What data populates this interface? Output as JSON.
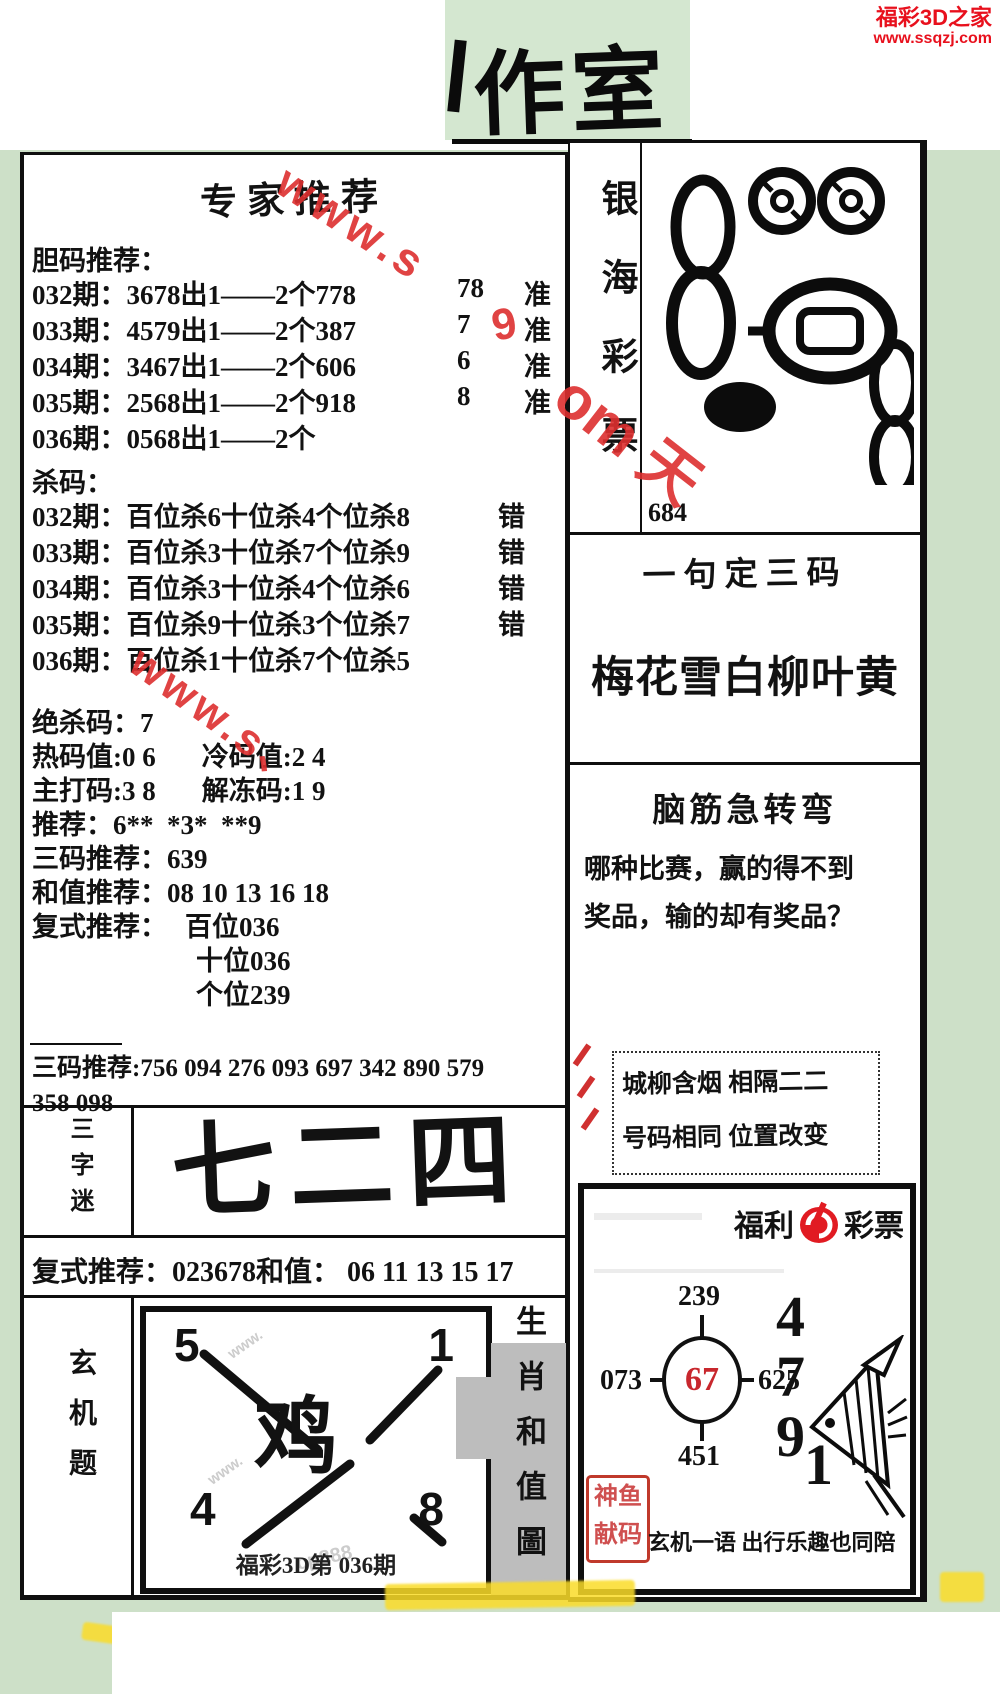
{
  "site": {
    "name": "福彩3D之家",
    "url": "www.ssqzj.com"
  },
  "masthead": {
    "title": "作室"
  },
  "left": {
    "title": "专家推荐",
    "danma_label": "胆码推荐：",
    "danma_rows": [
      {
        "period": "032期：",
        "text": "3678出1——2个778",
        "digit": "78",
        "result": "准"
      },
      {
        "period": "033期：",
        "text": "4579出1——2个387",
        "digit": "7",
        "result": "准"
      },
      {
        "period": "034期：",
        "text": "3467出1——2个606",
        "digit": "6",
        "result": "准"
      },
      {
        "period": "035期：",
        "text": "2568出1——2个918",
        "digit": "8",
        "result": "准"
      },
      {
        "period": "036期：",
        "text": "0568出1——2个",
        "digit": "",
        "result": ""
      }
    ],
    "shama_label": "杀码：",
    "shama_rows": [
      {
        "period": "032期：",
        "text": "百位杀6十位杀4个位杀8",
        "result": "错"
      },
      {
        "period": "033期：",
        "text": "百位杀3十位杀7个位杀9",
        "result": "错"
      },
      {
        "period": "034期：",
        "text": "百位杀3十位杀4个位杀6",
        "result": "错"
      },
      {
        "period": "035期：",
        "text": "百位杀9十位杀3个位杀7",
        "result": "错"
      },
      {
        "period": "036期：",
        "text": "百位杀1十位杀7个位杀5",
        "result": ""
      }
    ],
    "juesha": {
      "label": "绝杀码：",
      "value": "7"
    },
    "hot": {
      "label": "热码值:",
      "value": "0 6"
    },
    "cold": {
      "label": "冷码值:",
      "value": "2 4"
    },
    "zhuda": {
      "label": "主打码:",
      "value": "3 8"
    },
    "jiedong": {
      "label": "解冻码:",
      "value": "1 9"
    },
    "tuijian": {
      "label": "推荐：",
      "value": "6**  *3*  **9"
    },
    "sanma": {
      "label": "三码推荐：",
      "value": "639"
    },
    "hezhi": {
      "label": "和值推荐：",
      "value": "08 10 13 16 18"
    },
    "fushi": {
      "label": "复式推荐：",
      "bai": "百位036",
      "shi": "十位036",
      "ge": "个位239"
    },
    "sanma_list": {
      "label": "三码推荐:",
      "line1": "756 094 276 093 697 342 890 579",
      "line2": "358 098"
    },
    "sanzimi": {
      "label": "三字迷",
      "value": "七二四"
    },
    "fushi2": {
      "label": "复式推荐：",
      "value": "023678和值： 06 11 13 15 17"
    },
    "xuanji": {
      "label": "玄机题",
      "zodiac": "鸡",
      "corner_tl": "5",
      "corner_tr": "1",
      "corner_bl": "4",
      "corner_br": "8",
      "caption": "福彩3D第 036期"
    },
    "shengxiao_label": "生肖和值圖"
  },
  "right": {
    "yinhai_label": "银海彩票",
    "yinhai_number": "684",
    "yiju_title": "一句定三码",
    "yiju_phrase": "梅花雪白柳叶黄",
    "naojin_title": "脑筋急转弯",
    "naojin_line1": "哪种比赛，赢的得不到",
    "naojin_line2": "奖品，输的却有奖品？",
    "chengliu_line1": "城柳含烟 相隔二二",
    "chengliu_line2": "号码相同 位置改变",
    "card": {
      "brand_left": "福利",
      "brand_right": "彩票",
      "cross": {
        "top": "239",
        "left": "073",
        "center": "67",
        "right": "625",
        "bottom": "451"
      },
      "big_digits": [
        "4",
        "7",
        "9",
        "1"
      ],
      "stamp_line1": "神鱼",
      "stamp_line2": "献码",
      "slogan": "玄机一语 出行乐趣也同陪"
    }
  },
  "watermarks": {
    "top": "www.s",
    "digit": "9",
    "left": "www.s、",
    "right": "om 天",
    "faint1": "www.",
    "faint2": "www.",
    "cp": "cp888"
  },
  "colors": {
    "page_bg": "#cde0c8",
    "accent_red": "#e8101d",
    "logo_red": "#e11b22",
    "gray_block": "#bdbdbd"
  }
}
